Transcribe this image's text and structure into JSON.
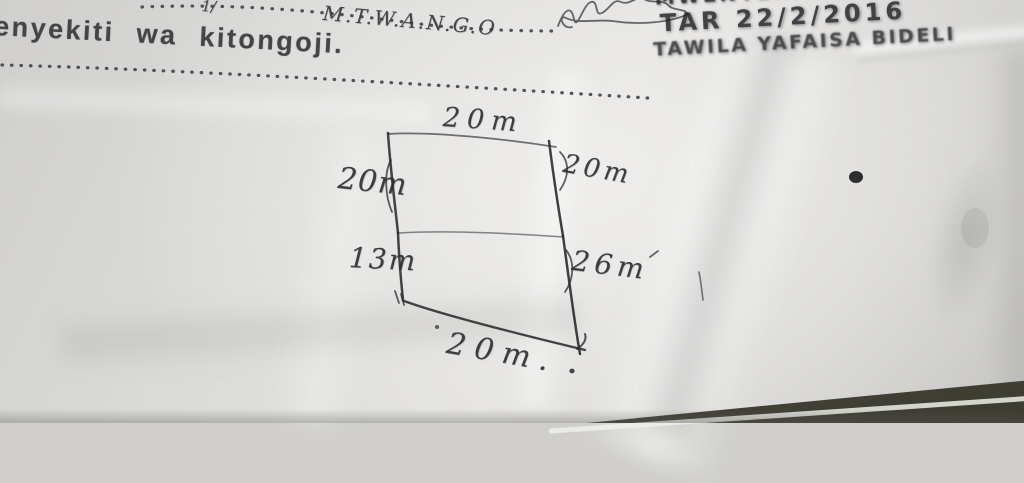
{
  "page": {
    "printed_header": "enyekiti wa kitongoji.",
    "dotted_line1_fragment": "1/",
    "place_name": "M.T.W.A.N.G.O",
    "corner_notes": {
      "line1_cut_off": "MWENYEKITI",
      "line2_date": "TAR 22/2/2016",
      "line3": "TAWILA YAFAISA BIDELI"
    }
  },
  "diagram": {
    "type": "hand-drawn land plot sketch, two stacked sections",
    "labels": {
      "top": "20m",
      "left_upper": "20m",
      "right_upper": "20m",
      "left_lower": "13m",
      "right_lower": "26m",
      "bottom": "20m."
    },
    "measurements_m": {
      "top": 20,
      "left_upper": 20,
      "right_upper": 20,
      "left_lower": 13,
      "right_lower": 26,
      "bottom": 20
    }
  },
  "colors": {
    "paper": "#dcdbd9",
    "ink": "#2b2b2e",
    "printed_text": "#454548",
    "table_surface": "#4a4940"
  }
}
